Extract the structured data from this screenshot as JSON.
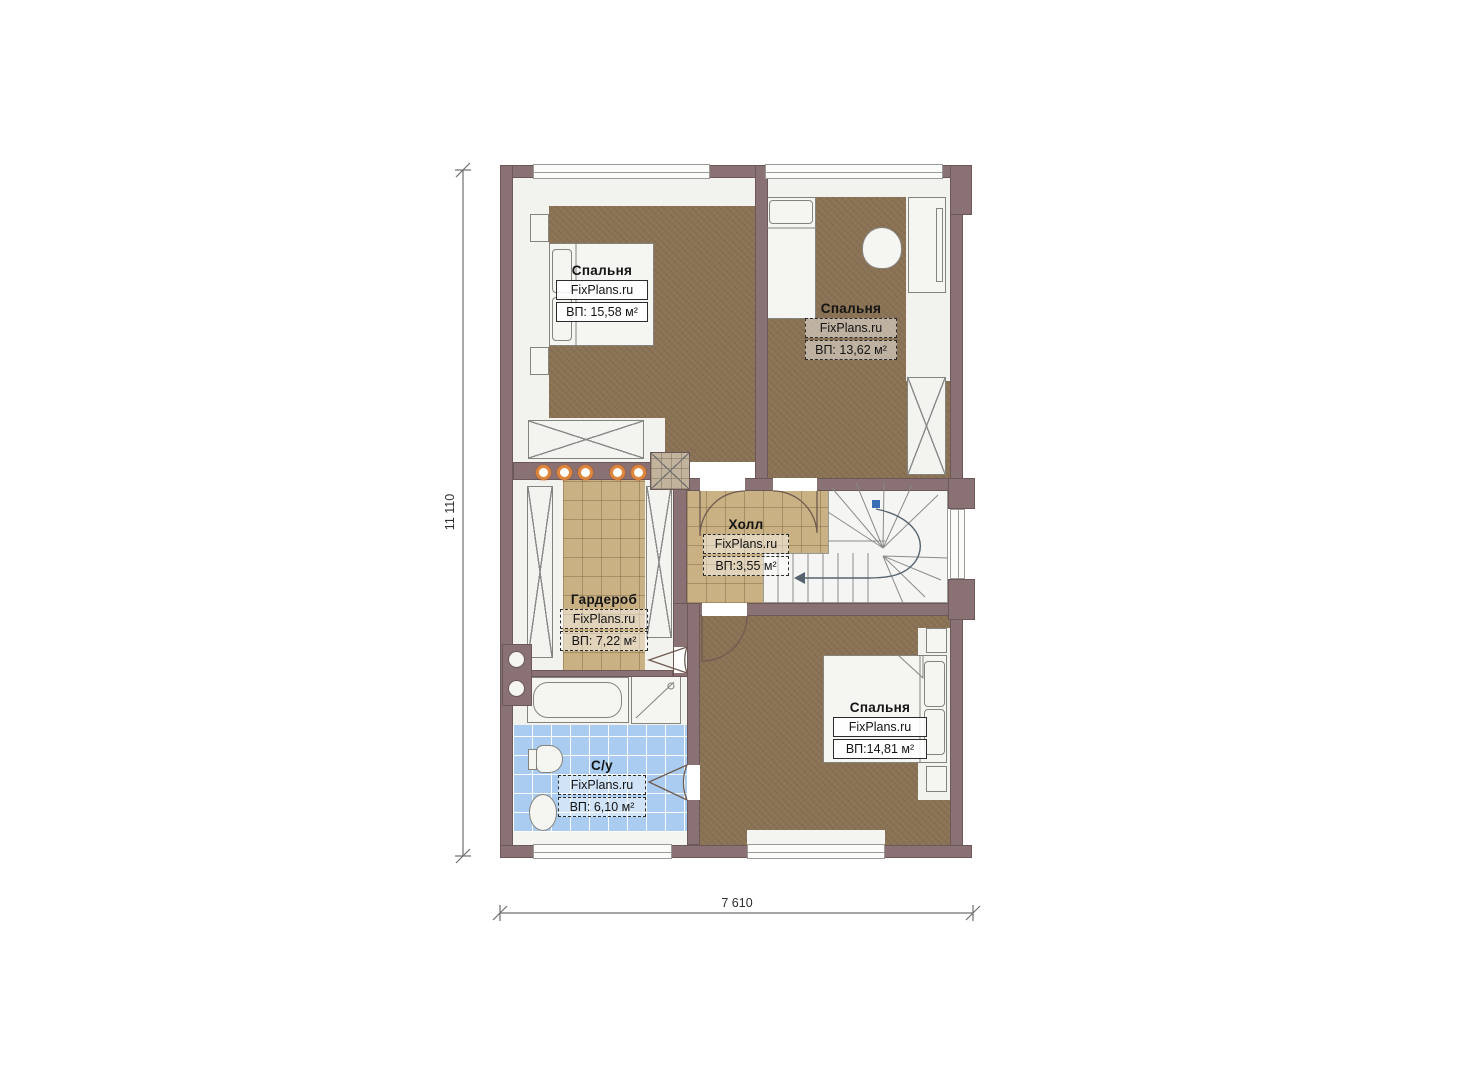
{
  "plan": {
    "type": "floor-plan",
    "brand": "FixPlans.ru",
    "dimensions": {
      "height_label": "11 110",
      "width_label": "7 610"
    },
    "rooms": [
      {
        "key": "bedroom-1",
        "name": "Спальня",
        "brand": "FixPlans.ru",
        "area": "ВП: 15,58 м²"
      },
      {
        "key": "bedroom-2",
        "name": "Спальня",
        "brand": "FixPlans.ru",
        "area": "ВП: 13,62 м²"
      },
      {
        "key": "hall",
        "name": "Холл",
        "brand": "FixPlans.ru",
        "area": "ВП:3,55 м²"
      },
      {
        "key": "wardrobe",
        "name": "Гардероб",
        "brand": "FixPlans.ru",
        "area": "ВП: 7,22 м²"
      },
      {
        "key": "bathroom",
        "name": "С/у",
        "brand": "FixPlans.ru",
        "area": "ВП: 6,10 м²"
      },
      {
        "key": "bedroom-3",
        "name": "Спальня",
        "brand": "FixPlans.ru",
        "area": "ВП:14,81 м²"
      }
    ],
    "colors": {
      "wall": "#8a7173",
      "bedroom_floor": "#8b7355",
      "tile_floor": "#c9b183",
      "bathroom_floor": "#a9ccf0",
      "light_ring": "#e0863c",
      "stair_marker": "#3b6fb5"
    }
  }
}
